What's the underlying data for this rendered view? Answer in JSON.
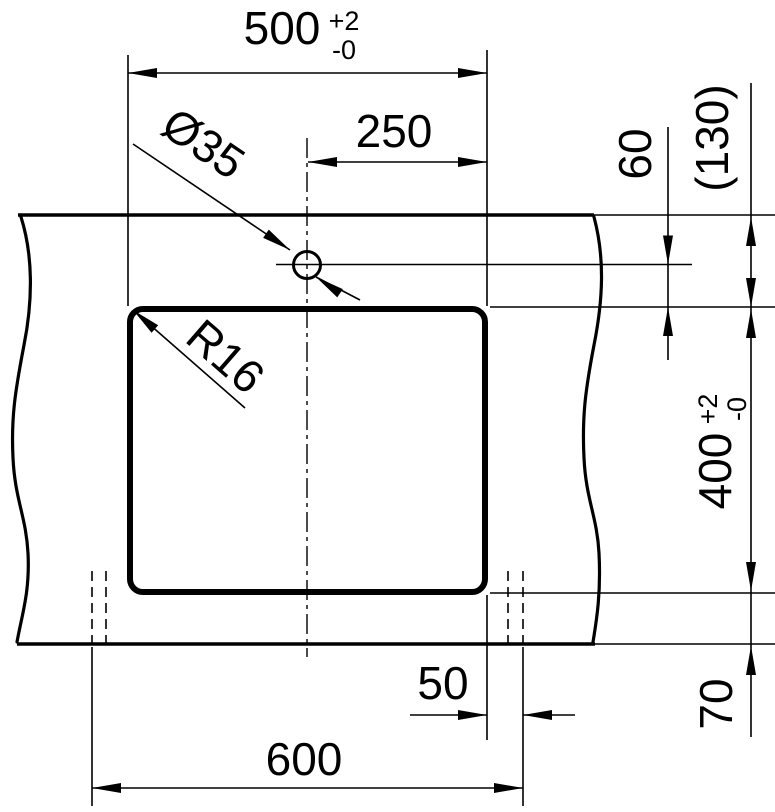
{
  "canvas": {
    "background": "#ffffff",
    "ink": "#000000"
  },
  "dimensions": {
    "width500": {
      "value": "500",
      "tol_plus": "+2",
      "tol_minus": "-0"
    },
    "offset250": {
      "value": "250"
    },
    "hole_dia": {
      "value": "Ø35"
    },
    "corner_radius": {
      "value": "R16"
    },
    "height400": {
      "value": "400",
      "tol_plus": "+2",
      "tol_minus": "-0"
    },
    "hole_offset60": {
      "value": "60"
    },
    "ref_depth130": {
      "value": "(130)"
    },
    "overall600": {
      "value": "600"
    },
    "edge_offset50": {
      "value": "50"
    },
    "front_offset70": {
      "value": "70"
    }
  }
}
